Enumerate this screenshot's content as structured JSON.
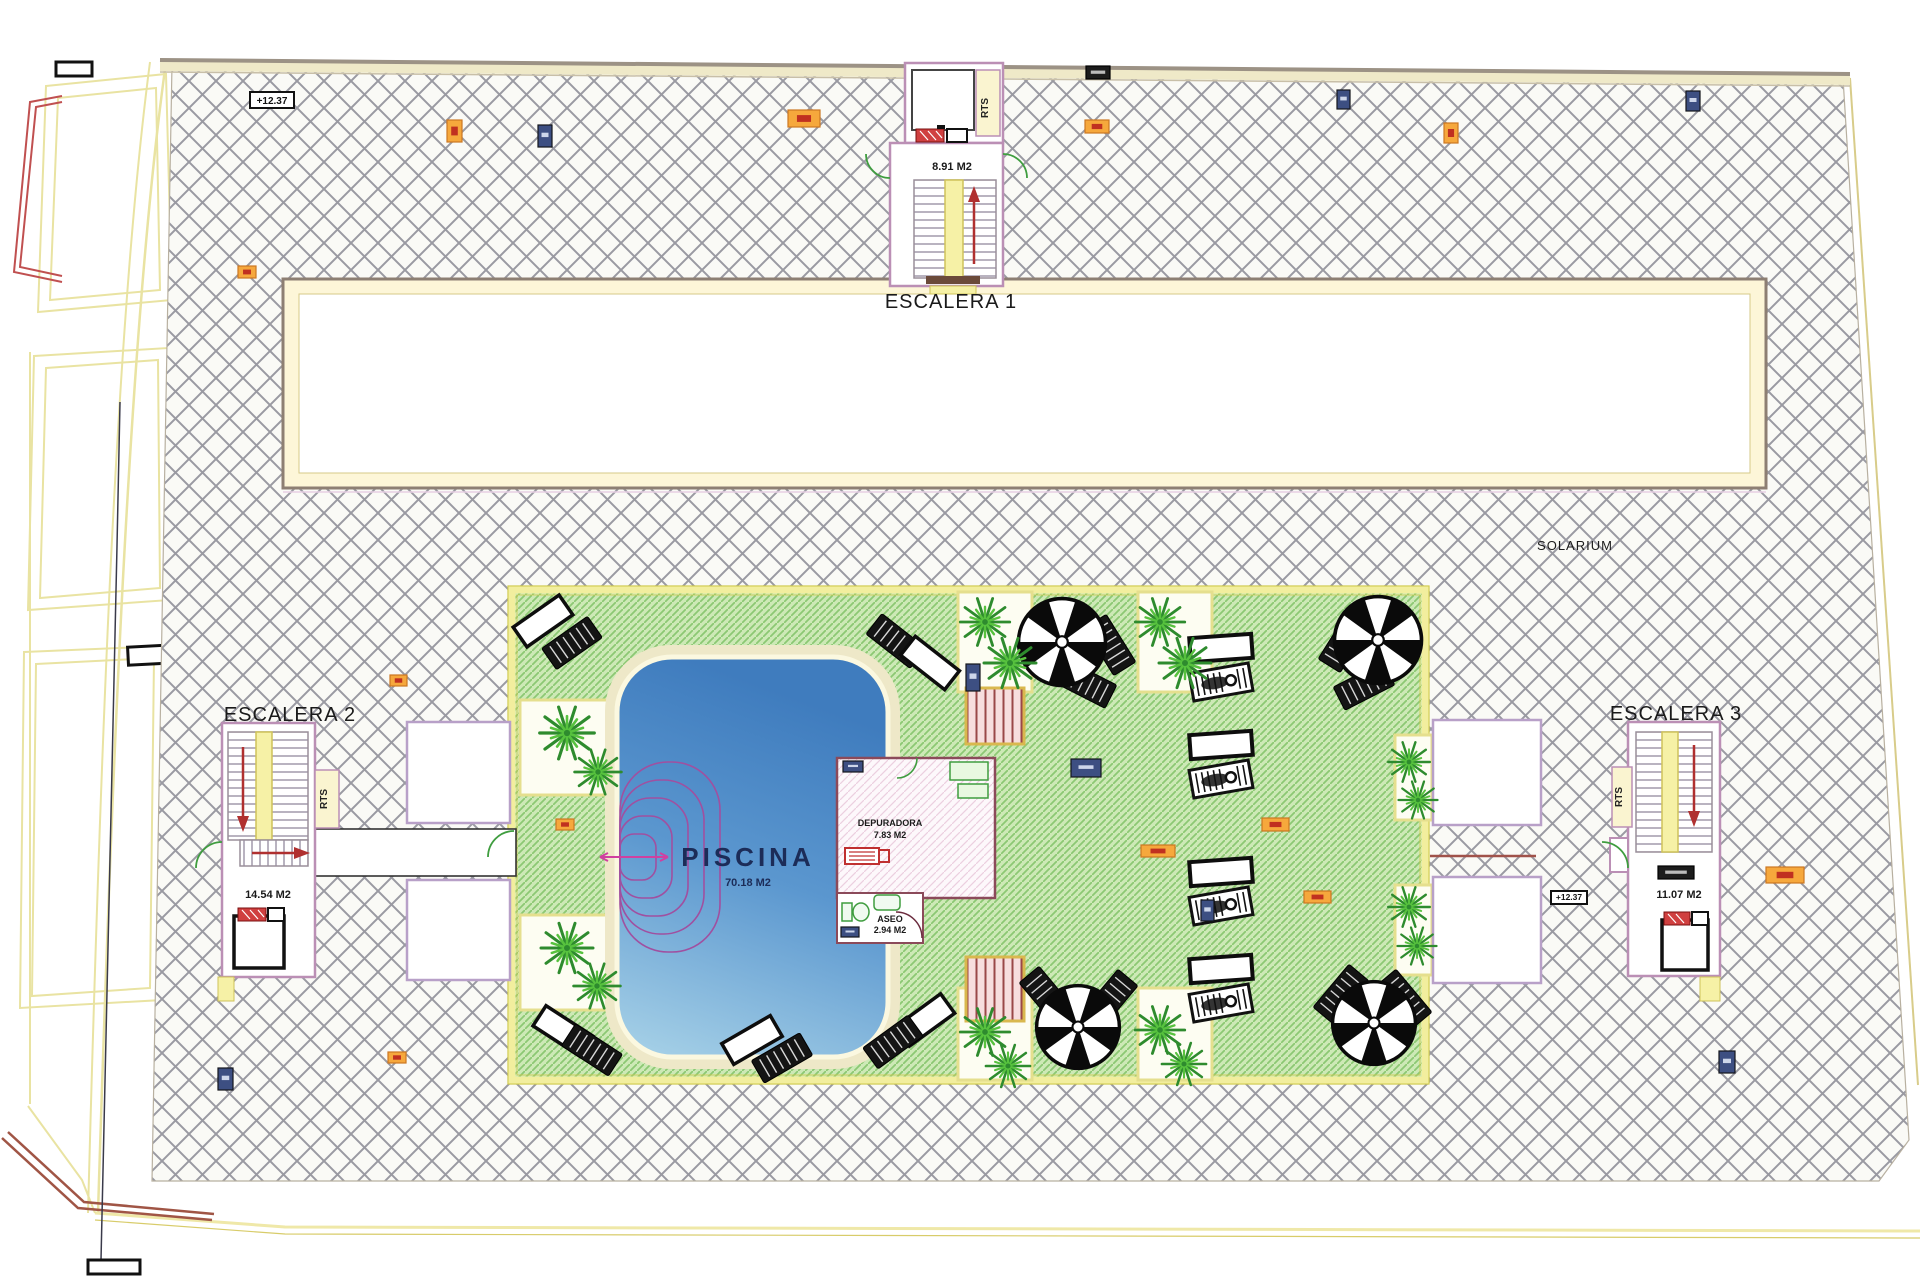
{
  "labels": {
    "escalera1": "ESCALERA 1",
    "escalera2": "ESCALERA 2",
    "escalera3": "ESCALERA 3",
    "solarium": "SOLARIUM",
    "piscina": "PISCINA",
    "piscina_area": "70.18 M2",
    "esc1_area": "8.91 M2",
    "esc2_area": "14.54 M2",
    "esc3_area": "11.07 M2",
    "depuradora": "DEPURADORA",
    "depuradora_area": "7.83 M2",
    "aseo": "ASEO",
    "aseo_area": "2.94 M2",
    "rts": "RTS"
  },
  "colors": {
    "hatch_line": "#9a9aa2",
    "green_deck": "#cde9b6",
    "green_hatch_line": "#8cc873",
    "deck_border": "#f2ee9e",
    "pool_top": "#3f7cbe",
    "pool_bottom": "#a9d3e8",
    "wall_pink": "#bb8fb5",
    "wall_maroon": "#8b4a5a",
    "stair_yellow": "#f6f1a6",
    "arrow_red": "#b03030",
    "door_green": "#3f9d3f",
    "marker_orange": "#f6a83c",
    "marker_blue": "#3d4f82",
    "boundary_tan": "#9c9285",
    "boundary_yellow": "#e9e3a2"
  },
  "markers": [
    {
      "kind": "level",
      "x": 250,
      "y": 92,
      "w": 44,
      "h": 16,
      "text": "+12.37"
    },
    {
      "kind": "level_sm",
      "x": 1551,
      "y": 891,
      "w": 36,
      "h": 13,
      "text": "+12.37"
    },
    {
      "kind": "orange",
      "x": 447,
      "y": 120,
      "w": 15,
      "h": 22
    },
    {
      "kind": "orange",
      "x": 1444,
      "y": 123,
      "w": 14,
      "h": 20
    },
    {
      "kind": "blue",
      "x": 538,
      "y": 125,
      "w": 14,
      "h": 22
    },
    {
      "kind": "blue",
      "x": 1337,
      "y": 90,
      "w": 13,
      "h": 19
    },
    {
      "kind": "blue",
      "x": 1686,
      "y": 91,
      "w": 14,
      "h": 20
    },
    {
      "kind": "blue",
      "x": 218,
      "y": 1068,
      "w": 15,
      "h": 22
    },
    {
      "kind": "blue",
      "x": 1719,
      "y": 1051,
      "w": 16,
      "h": 22
    },
    {
      "kind": "blue",
      "x": 966,
      "y": 664,
      "w": 14,
      "h": 27
    },
    {
      "kind": "blue",
      "x": 1201,
      "y": 900,
      "w": 13,
      "h": 21
    },
    {
      "kind": "orange",
      "x": 788,
      "y": 110,
      "w": 32,
      "h": 17
    },
    {
      "kind": "orange",
      "x": 1085,
      "y": 120,
      "w": 24,
      "h": 13
    },
    {
      "kind": "orange",
      "x": 238,
      "y": 266,
      "w": 18,
      "h": 12
    },
    {
      "kind": "orange",
      "x": 390,
      "y": 675,
      "w": 17,
      "h": 11
    },
    {
      "kind": "orange",
      "x": 556,
      "y": 819,
      "w": 18,
      "h": 11
    },
    {
      "kind": "orange",
      "x": 388,
      "y": 1052,
      "w": 18,
      "h": 11
    },
    {
      "kind": "orange",
      "x": 1766,
      "y": 867,
      "w": 38,
      "h": 16
    },
    {
      "kind": "orange",
      "x": 1262,
      "y": 818,
      "w": 27,
      "h": 13
    },
    {
      "kind": "orange",
      "x": 1141,
      "y": 845,
      "w": 34,
      "h": 12
    },
    {
      "kind": "orange",
      "x": 1304,
      "y": 891,
      "w": 27,
      "h": 12
    },
    {
      "kind": "blue",
      "x": 843,
      "y": 761,
      "w": 20,
      "h": 11
    },
    {
      "kind": "blue",
      "x": 841,
      "y": 927,
      "w": 18,
      "h": 10
    },
    {
      "kind": "blue",
      "x": 1071,
      "y": 759,
      "w": 30,
      "h": 18
    },
    {
      "kind": "dark",
      "x": 1086,
      "y": 66,
      "w": 24,
      "h": 13
    },
    {
      "kind": "dark",
      "x": 1658,
      "y": 866,
      "w": 36,
      "h": 13
    }
  ],
  "furniture": {
    "palms": [
      [
        567,
        733,
        1.05
      ],
      [
        598,
        772,
        0.9
      ],
      [
        567,
        948,
        1.0
      ],
      [
        597,
        986,
        0.9
      ],
      [
        985,
        622,
        0.95
      ],
      [
        1010,
        663,
        1.0
      ],
      [
        1160,
        622,
        0.95
      ],
      [
        1185,
        663,
        1.0
      ],
      [
        1409,
        762,
        0.8
      ],
      [
        1418,
        800,
        0.75
      ],
      [
        1409,
        907,
        0.8
      ],
      [
        1417,
        946,
        0.75
      ],
      [
        985,
        1032,
        0.95
      ],
      [
        1008,
        1066,
        0.85
      ],
      [
        1160,
        1030,
        0.95
      ],
      [
        1184,
        1064,
        0.85
      ]
    ],
    "umbrellas": [
      [
        1062,
        642,
        1.45
      ],
      [
        1378,
        640,
        1.45
      ],
      [
        1078,
        1027,
        1.38
      ],
      [
        1374,
        1023,
        1.38
      ]
    ],
    "loungers": [
      [
        "white",
        543,
        621,
        -35
      ],
      [
        "dark",
        572,
        643,
        -35
      ],
      [
        "dark",
        896,
        641,
        38
      ],
      [
        "white",
        930,
        663,
        38
      ],
      [
        "dark",
        1110,
        645,
        58
      ],
      [
        "dark",
        1086,
        684,
        27
      ],
      [
        "dark",
        1344,
        642,
        -58
      ],
      [
        "dark",
        1364,
        686,
        -27
      ],
      [
        "dark",
        1047,
        996,
        50
      ],
      [
        "dark",
        1110,
        999,
        -50
      ],
      [
        "white",
        563,
        1031,
        33
      ],
      [
        "dark",
        592,
        1050,
        33
      ],
      [
        "white",
        925,
        1020,
        -36
      ],
      [
        "dark",
        893,
        1042,
        -36
      ],
      [
        "white",
        752,
        1040,
        -30
      ],
      [
        "dark",
        782,
        1058,
        -30
      ],
      [
        "dark",
        1341,
        994,
        -50
      ],
      [
        "dark",
        1404,
        999,
        50
      ],
      [
        "table",
        1221,
        648,
        -4
      ],
      [
        "figure",
        1221,
        682,
        -10
      ],
      [
        "table",
        1221,
        745,
        -4
      ],
      [
        "figure",
        1221,
        779,
        -10
      ],
      [
        "table",
        1221,
        872,
        -4
      ],
      [
        "figure",
        1221,
        906,
        -10
      ],
      [
        "table",
        1221,
        969,
        -4
      ],
      [
        "figure",
        1221,
        1003,
        -10
      ]
    ]
  }
}
